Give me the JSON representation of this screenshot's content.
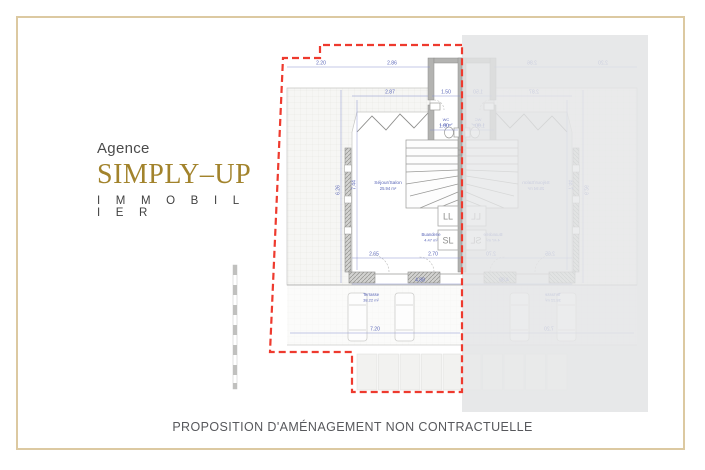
{
  "page": {
    "background": "#ffffff",
    "border_color": "#dcc9a1"
  },
  "logo": {
    "agency_label": "Agence",
    "brand": "SIMPLY–UP",
    "tagline": "I M M O B I L I E R",
    "gold": "#a2832c",
    "dark": "#474747"
  },
  "footer": {
    "disclaimer": "PROPOSITION D'AMÉNAGEMENT NON CONTRACTUELLE"
  },
  "plan": {
    "boundary_color": "#ee3a2e",
    "dimension_color": "#5a66b8",
    "overlay_color": "#e7e8e9",
    "rooms": [
      {
        "name": "Séjour/Salon",
        "area": "25.94 m²"
      },
      {
        "name": "Buanderie",
        "area": "4.47 m²"
      },
      {
        "name": "WC",
        "area": "1.45 m²"
      },
      {
        "name": "Terrasse",
        "area": "38.22 m²"
      }
    ],
    "appliances": [
      "LL",
      "SL"
    ],
    "dimensions": [
      "2.20",
      "2.86",
      "2.87",
      "1.50",
      "1.00",
      "2.65",
      "2.70",
      "4.88",
      "7.20",
      "7.44",
      "6.26"
    ]
  }
}
